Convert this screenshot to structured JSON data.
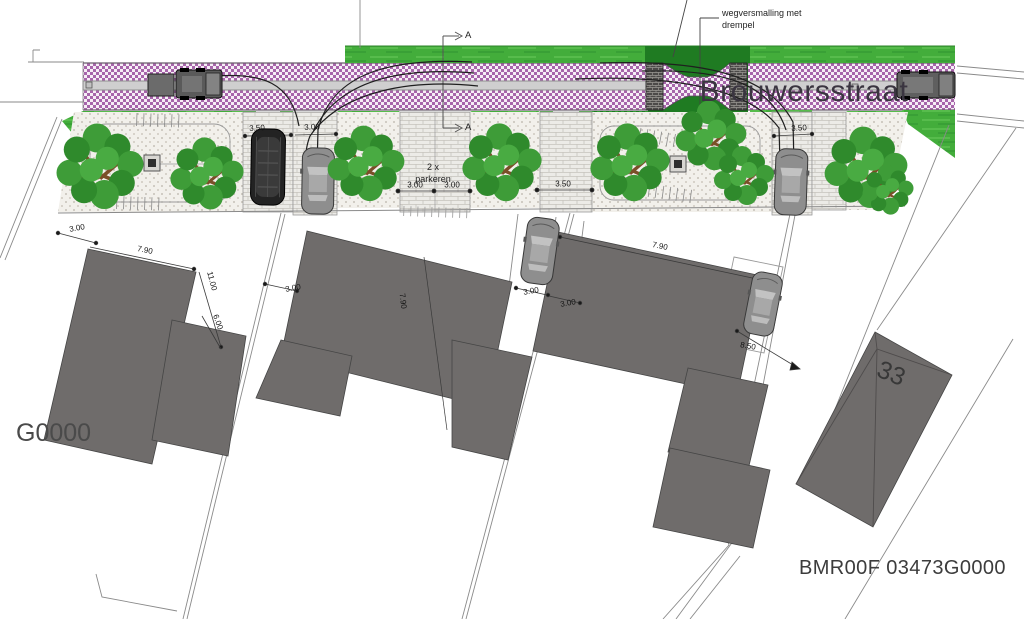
{
  "labels": {
    "street_name": "Brouwersstraat",
    "road_note_line1": "wegversmalling met",
    "road_note_line2": "drempel",
    "parking_note_line1": "2 x",
    "parking_note_line2": "parkeren",
    "parcel_left": "G0000",
    "parcel_right": "BMR00F 03473G0000",
    "house_number": "33",
    "section_marker": "A"
  },
  "dims": [
    "3.50",
    "3.00",
    "3.00",
    "3.00",
    "3.50",
    "3.50",
    "3.00",
    "7.90",
    "11.00",
    "6.00",
    "3.00",
    "7.90",
    "3.00",
    "3.00",
    "7.90",
    "8.50"
  ],
  "colors": {
    "road_paving": "#a765ab",
    "grass": "#43ad3b",
    "grass_dark": "#1f7b22",
    "building": "#6f6c6b",
    "asphalt_band": "#cfcfcf"
  }
}
